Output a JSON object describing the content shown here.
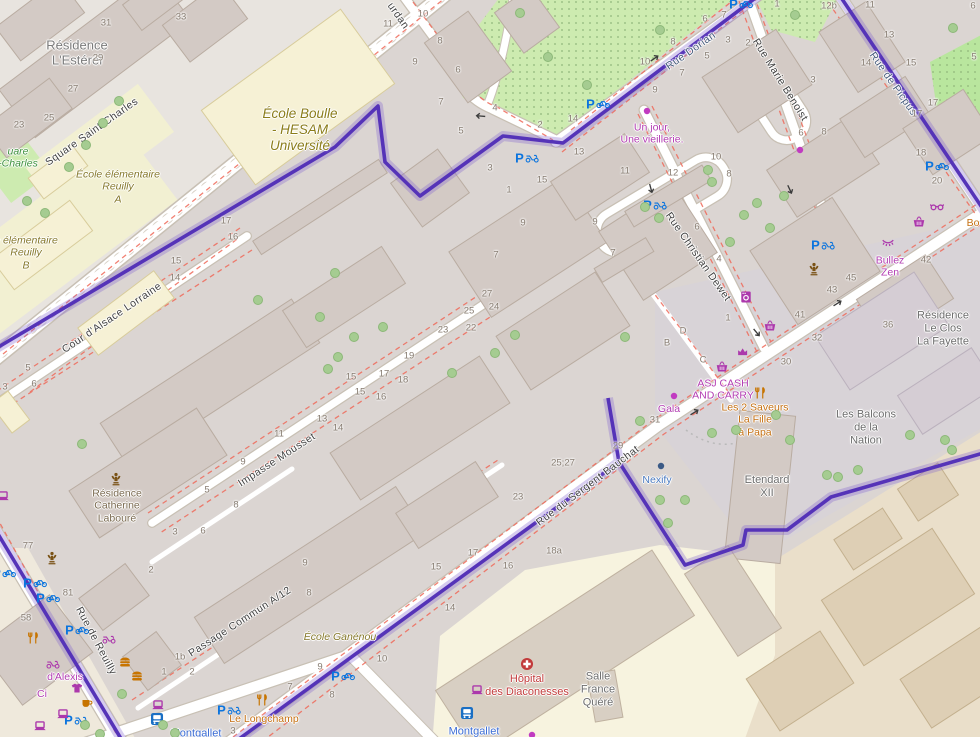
{
  "map_type": "street-map",
  "viewport": {
    "width": 980,
    "height": 737
  },
  "colors": {
    "boundary_purple": "#5533b8",
    "park_green": "#cdebb0",
    "building_grey": "#d3cac5",
    "school_yellow": "#f6f1d5",
    "shop_magenta": "#ac39ac",
    "food_orange": "#c77400",
    "parking_blue": "#0b74de",
    "hospital_red": "#c23b3b",
    "metro_blue": "#3b6cd4"
  },
  "labels": [
    {
      "name": "residence-esterel",
      "lines": [
        "Résidence",
        "L'Estérel"
      ],
      "x": 77,
      "y": 53,
      "rot": 0,
      "cls": "place"
    },
    {
      "name": "street-square-saint-charles",
      "lines": [
        "Square Saint-Charles"
      ],
      "x": 92,
      "y": 132,
      "rot": -35,
      "cls": "street"
    },
    {
      "name": "park-square-charles-fragment",
      "lines": [
        "uare",
        "-Charles"
      ],
      "x": 18,
      "y": 158,
      "rot": 0,
      "cls": "park"
    },
    {
      "name": "ecole-elementaire-reuilly-a",
      "lines": [
        "École élémentaire",
        "Reuilly",
        "A"
      ],
      "x": 118,
      "y": 187,
      "rot": 0,
      "cls": "school"
    },
    {
      "name": "ecole-elementaire-reuilly-b",
      "lines": [
        "e élémentaire",
        "Reuilly",
        "B"
      ],
      "x": 26,
      "y": 253,
      "rot": 0,
      "cls": "school"
    },
    {
      "name": "ecole-boulle",
      "lines": [
        "École Boulle",
        "- HESAM",
        "Université"
      ],
      "x": 300,
      "y": 130,
      "rot": 0,
      "cls": "school-lg"
    },
    {
      "name": "street-cour-alsace-lorraine",
      "lines": [
        "Cour d'Alsace Lorraine"
      ],
      "x": 112,
      "y": 318,
      "rot": -34,
      "cls": "street"
    },
    {
      "name": "street-impasse-mousset",
      "lines": [
        "Impasse Mousset"
      ],
      "x": 277,
      "y": 460,
      "rot": -33,
      "cls": "street"
    },
    {
      "name": "residence-catherine-laboure",
      "lines": [
        "Résidence",
        "Catherine",
        "Labouré"
      ],
      "x": 117,
      "y": 506,
      "rot": 0,
      "cls": "residence-brown"
    },
    {
      "name": "street-passage-commun",
      "lines": [
        "Passage Commun A/12"
      ],
      "x": 240,
      "y": 622,
      "rot": -33,
      "cls": "street"
    },
    {
      "name": "street-rue-de-reuilly",
      "lines": [
        "Rue de Reuilly"
      ],
      "x": 96,
      "y": 641,
      "rot": 62,
      "cls": "street"
    },
    {
      "name": "shop-d-alexis",
      "lines": [
        "d'Alexis"
      ],
      "x": 65,
      "y": 677,
      "rot": 0,
      "cls": "shop"
    },
    {
      "name": "shop-ci-fragment",
      "lines": [
        "Ci"
      ],
      "x": 42,
      "y": 694,
      "rot": 0,
      "cls": "shop"
    },
    {
      "name": "metro-montgallet-1",
      "lines": [
        "Montgallet"
      ],
      "x": 196,
      "y": 734,
      "rot": 0,
      "cls": "metro"
    },
    {
      "name": "metro-montgallet-2",
      "lines": [
        "Montgallet"
      ],
      "x": 474,
      "y": 732,
      "rot": 0,
      "cls": "metro"
    },
    {
      "name": "restaurant-le-longchamp",
      "lines": [
        "Le Longchamp"
      ],
      "x": 264,
      "y": 719,
      "rot": 0,
      "cls": "food"
    },
    {
      "name": "ecole-ganenou",
      "lines": [
        "École Ganénou"
      ],
      "x": 340,
      "y": 637,
      "rot": 0,
      "cls": "school"
    },
    {
      "name": "hopital-des-diaconesses",
      "lines": [
        "Hôpital",
        "des Diaconesses"
      ],
      "x": 527,
      "y": 686,
      "rot": 0,
      "cls": "hospital"
    },
    {
      "name": "salle-france-quere",
      "lines": [
        "Salle",
        "France",
        "Quéré"
      ],
      "x": 598,
      "y": 690,
      "rot": 0,
      "cls": "place-sm"
    },
    {
      "name": "street-rue-du-sergent-bauchat",
      "lines": [
        "Rue du Sergent Bauchat"
      ],
      "x": 588,
      "y": 486,
      "rot": -37,
      "cls": "street"
    },
    {
      "name": "office-nexify",
      "lines": [
        "Nexify"
      ],
      "x": 657,
      "y": 480,
      "rot": 0,
      "cls": "office-blue"
    },
    {
      "name": "etendard-xii",
      "lines": [
        "Etendard",
        "XII"
      ],
      "x": 767,
      "y": 487,
      "rot": 0,
      "cls": "place-sm"
    },
    {
      "name": "les-balcons-de-la-nation",
      "lines": [
        "Les Balcons",
        "de la",
        "Nation"
      ],
      "x": 866,
      "y": 428,
      "rot": 0,
      "cls": "place-sm"
    },
    {
      "name": "residence-le-clos-la-fayette",
      "lines": [
        "Résidence",
        "Le Clos",
        "La Fayette"
      ],
      "x": 943,
      "y": 329,
      "rot": 0,
      "cls": "place-sm"
    },
    {
      "name": "shop-gala",
      "lines": [
        "Gala"
      ],
      "x": 669,
      "y": 409,
      "rot": 0,
      "cls": "shop"
    },
    {
      "name": "shop-asj-cash-and-carry",
      "lines": [
        "ASJ CASH",
        "AND CARRY"
      ],
      "x": 723,
      "y": 390,
      "rot": 0,
      "cls": "shop"
    },
    {
      "name": "restaurant-les-2-saveurs",
      "lines": [
        "Les 2 Saveurs",
        "La Fille",
        "à Papa"
      ],
      "x": 755,
      "y": 420,
      "rot": 0,
      "cls": "food"
    },
    {
      "name": "shop-bullez-zen",
      "lines": [
        "Bullez",
        "Zen"
      ],
      "x": 890,
      "y": 267,
      "rot": 0,
      "cls": "shop"
    },
    {
      "name": "shop-un-jour-une-vieillerie",
      "lines": [
        "Un jour,",
        "Une vieillerie."
      ],
      "x": 652,
      "y": 134,
      "rot": 0,
      "cls": "shop"
    },
    {
      "name": "street-rue-christian-dewet",
      "lines": [
        "Rue Christian Dewet"
      ],
      "x": 698,
      "y": 257,
      "rot": 55,
      "cls": "street"
    },
    {
      "name": "street-rue-marie-benoist",
      "lines": [
        "Rue Marie Benoist"
      ],
      "x": 780,
      "y": 80,
      "rot": 58,
      "cls": "street"
    },
    {
      "name": "street-rue-dorian",
      "lines": [
        "Rue Dorian"
      ],
      "x": 691,
      "y": 51,
      "rot": -35,
      "cls": "street-blue"
    },
    {
      "name": "street-rue-de-picpus",
      "lines": [
        "Rue de Picpus"
      ],
      "x": 893,
      "y": 84,
      "rot": 55,
      "cls": "street-blue"
    },
    {
      "name": "street-bourdan-fragment",
      "lines": [
        "urdan"
      ],
      "x": 398,
      "y": 16,
      "rot": 55,
      "cls": "street"
    },
    {
      "name": "food-bo-fragment",
      "lines": [
        "Bo"
      ],
      "x": 973,
      "y": 223,
      "rot": 0,
      "cls": "food"
    }
  ],
  "housenumbers": [
    {
      "t": "33",
      "x": 181,
      "y": 17
    },
    {
      "t": "31",
      "x": 106,
      "y": 23
    },
    {
      "t": "29",
      "x": 98,
      "y": 58
    },
    {
      "t": "27",
      "x": 73,
      "y": 89
    },
    {
      "t": "25",
      "x": 49,
      "y": 118
    },
    {
      "t": "23",
      "x": 19,
      "y": 125
    },
    {
      "t": "17",
      "x": 226,
      "y": 221
    },
    {
      "t": "16",
      "x": 233,
      "y": 237
    },
    {
      "t": "15",
      "x": 176,
      "y": 261
    },
    {
      "t": "14",
      "x": 175,
      "y": 278
    },
    {
      "t": "5",
      "x": 28,
      "y": 368
    },
    {
      "t": "6",
      "x": 34,
      "y": 384
    },
    {
      "t": "3",
      "x": 5,
      "y": 387
    },
    {
      "t": "11",
      "x": 388,
      "y": 24
    },
    {
      "t": "10",
      "x": 423,
      "y": 14
    },
    {
      "t": "8",
      "x": 440,
      "y": 41
    },
    {
      "t": "9",
      "x": 415,
      "y": 62
    },
    {
      "t": "6",
      "x": 458,
      "y": 70
    },
    {
      "t": "7",
      "x": 441,
      "y": 102
    },
    {
      "t": "5",
      "x": 461,
      "y": 131
    },
    {
      "t": "4",
      "x": 495,
      "y": 108
    },
    {
      "t": "2",
      "x": 540,
      "y": 125
    },
    {
      "t": "3",
      "x": 490,
      "y": 168
    },
    {
      "t": "1",
      "x": 509,
      "y": 190
    },
    {
      "t": "14",
      "x": 573,
      "y": 119
    },
    {
      "t": "13",
      "x": 579,
      "y": 152
    },
    {
      "t": "15",
      "x": 542,
      "y": 180
    },
    {
      "t": "12b",
      "x": 829,
      "y": 6
    },
    {
      "t": "11",
      "x": 870,
      "y": 5
    },
    {
      "t": "1",
      "x": 777,
      "y": 4
    },
    {
      "t": "2",
      "x": 748,
      "y": 43
    },
    {
      "t": "3",
      "x": 813,
      "y": 80
    },
    {
      "t": "13",
      "x": 889,
      "y": 35
    },
    {
      "t": "14",
      "x": 866,
      "y": 63
    },
    {
      "t": "15",
      "x": 911,
      "y": 63
    },
    {
      "t": "17",
      "x": 933,
      "y": 103
    },
    {
      "t": "17",
      "x": 917,
      "y": 114
    },
    {
      "t": "18",
      "x": 921,
      "y": 153
    },
    {
      "t": "20",
      "x": 937,
      "y": 181
    },
    {
      "t": "42",
      "x": 926,
      "y": 260
    },
    {
      "t": "6",
      "x": 973,
      "y": 6
    },
    {
      "t": "5",
      "x": 974,
      "y": 57
    },
    {
      "t": "10",
      "x": 645,
      "y": 62
    },
    {
      "t": "8",
      "x": 673,
      "y": 42
    },
    {
      "t": "6",
      "x": 705,
      "y": 19
    },
    {
      "t": "7",
      "x": 724,
      "y": 15
    },
    {
      "t": "9",
      "x": 655,
      "y": 90
    },
    {
      "t": "5",
      "x": 707,
      "y": 56
    },
    {
      "t": "3",
      "x": 728,
      "y": 40
    },
    {
      "t": "7",
      "x": 682,
      "y": 73
    },
    {
      "t": "12",
      "x": 673,
      "y": 173
    },
    {
      "t": "11",
      "x": 625,
      "y": 171
    },
    {
      "t": "10",
      "x": 716,
      "y": 157
    },
    {
      "t": "8",
      "x": 729,
      "y": 174
    },
    {
      "t": "9",
      "x": 595,
      "y": 222
    },
    {
      "t": "7",
      "x": 613,
      "y": 253
    },
    {
      "t": "6",
      "x": 697,
      "y": 227
    },
    {
      "t": "9",
      "x": 523,
      "y": 223
    },
    {
      "t": "7",
      "x": 496,
      "y": 255
    },
    {
      "t": "4",
      "x": 719,
      "y": 259
    },
    {
      "t": "1",
      "x": 728,
      "y": 318
    },
    {
      "t": "D",
      "x": 683,
      "y": 331
    },
    {
      "t": "B",
      "x": 667,
      "y": 343
    },
    {
      "t": "C",
      "x": 703,
      "y": 360
    },
    {
      "t": "41",
      "x": 800,
      "y": 315
    },
    {
      "t": "43",
      "x": 832,
      "y": 290
    },
    {
      "t": "45",
      "x": 851,
      "y": 278
    },
    {
      "t": "30",
      "x": 786,
      "y": 362
    },
    {
      "t": "32",
      "x": 817,
      "y": 338
    },
    {
      "t": "36",
      "x": 888,
      "y": 325
    },
    {
      "t": "8",
      "x": 824,
      "y": 132
    },
    {
      "t": "6",
      "x": 801,
      "y": 133
    },
    {
      "t": "31",
      "x": 655,
      "y": 420
    },
    {
      "t": "29",
      "x": 618,
      "y": 446
    },
    {
      "t": "25;27",
      "x": 563,
      "y": 463
    },
    {
      "t": "23",
      "x": 518,
      "y": 497
    },
    {
      "t": "18a",
      "x": 554,
      "y": 551
    },
    {
      "t": "17",
      "x": 473,
      "y": 553
    },
    {
      "t": "16",
      "x": 508,
      "y": 566
    },
    {
      "t": "15",
      "x": 436,
      "y": 567
    },
    {
      "t": "14",
      "x": 450,
      "y": 608
    },
    {
      "t": "10",
      "x": 382,
      "y": 659
    },
    {
      "t": "9",
      "x": 320,
      "y": 667
    },
    {
      "t": "8",
      "x": 332,
      "y": 695
    },
    {
      "t": "7",
      "x": 290,
      "y": 687
    },
    {
      "t": "27",
      "x": 487,
      "y": 294
    },
    {
      "t": "24",
      "x": 494,
      "y": 307
    },
    {
      "t": "25",
      "x": 469,
      "y": 311
    },
    {
      "t": "22",
      "x": 471,
      "y": 328
    },
    {
      "t": "23",
      "x": 443,
      "y": 330
    },
    {
      "t": "19",
      "x": 409,
      "y": 356
    },
    {
      "t": "18",
      "x": 403,
      "y": 380
    },
    {
      "t": "17",
      "x": 384,
      "y": 374
    },
    {
      "t": "15",
      "x": 351,
      "y": 377
    },
    {
      "t": "15",
      "x": 360,
      "y": 392
    },
    {
      "t": "16",
      "x": 381,
      "y": 397
    },
    {
      "t": "13",
      "x": 322,
      "y": 419
    },
    {
      "t": "14",
      "x": 338,
      "y": 428
    },
    {
      "t": "11",
      "x": 279,
      "y": 434
    },
    {
      "t": "9",
      "x": 243,
      "y": 462
    },
    {
      "t": "5",
      "x": 207,
      "y": 490
    },
    {
      "t": "8",
      "x": 236,
      "y": 505
    },
    {
      "t": "3",
      "x": 175,
      "y": 532
    },
    {
      "t": "6",
      "x": 203,
      "y": 531
    },
    {
      "t": "2",
      "x": 151,
      "y": 570
    },
    {
      "t": "9",
      "x": 305,
      "y": 563
    },
    {
      "t": "8",
      "x": 309,
      "y": 593
    },
    {
      "t": "1b",
      "x": 180,
      "y": 657
    },
    {
      "t": "1",
      "x": 164,
      "y": 672
    },
    {
      "t": "2",
      "x": 192,
      "y": 672
    },
    {
      "t": "3",
      "x": 233,
      "y": 731
    },
    {
      "t": "77",
      "x": 28,
      "y": 546
    },
    {
      "t": "81",
      "x": 68,
      "y": 593
    },
    {
      "t": "58",
      "x": 26,
      "y": 618
    }
  ],
  "pois": [
    {
      "g": "parking-bike",
      "x": 741,
      "y": 4
    },
    {
      "g": "parking-bike",
      "x": 598,
      "y": 104
    },
    {
      "g": "parking-bike",
      "x": 937,
      "y": 166
    },
    {
      "g": "parking-bike",
      "x": 343,
      "y": 676
    },
    {
      "g": "parking-bike",
      "x": 4,
      "y": 573
    },
    {
      "g": "parking-bike",
      "x": 35,
      "y": 583
    },
    {
      "g": "parking-bike",
      "x": 48,
      "y": 598
    },
    {
      "g": "parking-bike",
      "x": 77,
      "y": 630
    },
    {
      "g": "parking-moto",
      "x": 527,
      "y": 158
    },
    {
      "g": "parking-moto",
      "x": 655,
      "y": 205
    },
    {
      "g": "parking-moto",
      "x": 823,
      "y": 245
    },
    {
      "g": "parking-moto",
      "x": 76,
      "y": 720
    },
    {
      "g": "parking-moto",
      "x": 229,
      "y": 710
    },
    {
      "g": "supermarket-basket",
      "x": 919,
      "y": 222
    },
    {
      "g": "supermarket-basket",
      "x": 770,
      "y": 326
    },
    {
      "g": "supermarket-basket",
      "x": 722,
      "y": 367
    },
    {
      "g": "bakery",
      "x": 743,
      "y": 351
    },
    {
      "g": "laundry",
      "x": 746,
      "y": 297
    },
    {
      "g": "glasses-shop",
      "x": 937,
      "y": 207
    },
    {
      "g": "beauty-eyelash",
      "x": 888,
      "y": 243
    },
    {
      "g": "memorial-statue",
      "x": 116,
      "y": 479
    },
    {
      "g": "memorial-statue",
      "x": 52,
      "y": 558
    },
    {
      "g": "memorial-statue",
      "x": 814,
      "y": 269
    },
    {
      "g": "clothes-shop",
      "x": 77,
      "y": 688
    },
    {
      "g": "scooter-shop",
      "x": 53,
      "y": 664
    },
    {
      "g": "scooter-shop",
      "x": 109,
      "y": 639
    },
    {
      "g": "cafe",
      "x": 87,
      "y": 703
    },
    {
      "g": "fastfood-burger",
      "x": 125,
      "y": 662
    },
    {
      "g": "fastfood-burger",
      "x": 137,
      "y": 676
    },
    {
      "g": "restaurant-cutlery",
      "x": 33,
      "y": 638
    },
    {
      "g": "restaurant-cutlery",
      "x": 760,
      "y": 393
    },
    {
      "g": "restaurant-cutlery",
      "x": 262,
      "y": 700
    },
    {
      "g": "computer-shop",
      "x": 3,
      "y": 496
    },
    {
      "g": "computer-shop",
      "x": 63,
      "y": 714
    },
    {
      "g": "computer-shop",
      "x": 40,
      "y": 726
    },
    {
      "g": "computer-shop",
      "x": 158,
      "y": 705
    },
    {
      "g": "computer-shop",
      "x": 477,
      "y": 690
    },
    {
      "g": "bus-stop",
      "x": 157,
      "y": 719
    },
    {
      "g": "bus-stop",
      "x": 467,
      "y": 713
    },
    {
      "g": "hospital-cross",
      "x": 527,
      "y": 664
    },
    {
      "g": "poi-dot-magenta",
      "x": 647,
      "y": 111
    },
    {
      "g": "poi-dot-magenta",
      "x": 674,
      "y": 396
    },
    {
      "g": "poi-dot-magenta",
      "x": 800,
      "y": 150
    },
    {
      "g": "poi-dot-magenta",
      "x": 532,
      "y": 735
    },
    {
      "g": "poi-dot-navy",
      "x": 661,
      "y": 466
    },
    {
      "g": "oneway-arrow",
      "x": 480,
      "y": 116,
      "rot": 185
    },
    {
      "g": "oneway-arrow",
      "x": 655,
      "y": 58,
      "rot": -35
    },
    {
      "g": "oneway-arrow",
      "x": 651,
      "y": 189,
      "rot": 75
    },
    {
      "g": "oneway-arrow",
      "x": 757,
      "y": 333,
      "rot": 50
    },
    {
      "g": "oneway-arrow",
      "x": 695,
      "y": 412,
      "rot": -32
    },
    {
      "g": "oneway-arrow",
      "x": 838,
      "y": 303,
      "rot": -32
    },
    {
      "g": "oneway-arrow",
      "x": 790,
      "y": 190,
      "rot": 65
    }
  ],
  "trees": [
    [
      119,
      101
    ],
    [
      103,
      123
    ],
    [
      86,
      145
    ],
    [
      69,
      167
    ],
    [
      27,
      201
    ],
    [
      45,
      213
    ],
    [
      82,
      444
    ],
    [
      520,
      13
    ],
    [
      548,
      57
    ],
    [
      587,
      85
    ],
    [
      660,
      30
    ],
    [
      953,
      28
    ],
    [
      795,
      15
    ],
    [
      335,
      273
    ],
    [
      320,
      317
    ],
    [
      354,
      337
    ],
    [
      338,
      357
    ],
    [
      328,
      369
    ],
    [
      383,
      327
    ],
    [
      452,
      373
    ],
    [
      495,
      353
    ],
    [
      515,
      335
    ],
    [
      258,
      300
    ],
    [
      708,
      170
    ],
    [
      659,
      218
    ],
    [
      645,
      207
    ],
    [
      744,
      215
    ],
    [
      757,
      203
    ],
    [
      770,
      228
    ],
    [
      784,
      196
    ],
    [
      730,
      242
    ],
    [
      712,
      182
    ],
    [
      625,
      337
    ],
    [
      640,
      421
    ],
    [
      910,
      435
    ],
    [
      945,
      440
    ],
    [
      952,
      450
    ],
    [
      827,
      475
    ],
    [
      838,
      477
    ],
    [
      858,
      470
    ],
    [
      685,
      500
    ],
    [
      668,
      523
    ],
    [
      660,
      500
    ],
    [
      736,
      430
    ],
    [
      712,
      433
    ],
    [
      776,
      415
    ],
    [
      790,
      440
    ],
    [
      85,
      725
    ],
    [
      100,
      734
    ],
    [
      122,
      694
    ],
    [
      163,
      725
    ],
    [
      175,
      733
    ]
  ]
}
